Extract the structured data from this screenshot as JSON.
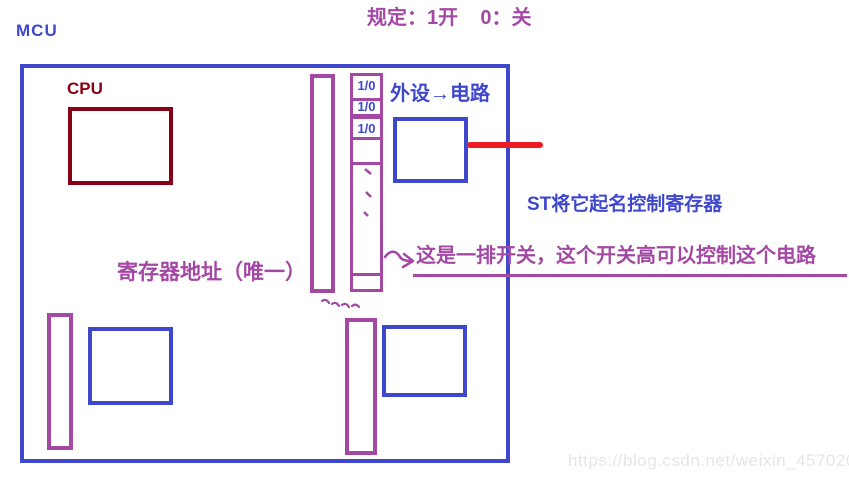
{
  "header": {
    "mcu_title": "MCU",
    "rule_text": "规定：1开    0：关"
  },
  "mcu": {
    "cpu_label": "CPU",
    "register_address_label": "寄存器地址（唯一）",
    "peripheral_label": "外设→电路",
    "switch_cells": [
      "1/0",
      "1/0",
      "1/0"
    ]
  },
  "annotations": {
    "st_register_note": "ST将它起名控制寄存器",
    "switch_row_note": "这是一排开关，这个开关高可以控制这个电路"
  },
  "icons": {
    "arrow": "curved-arrow-icon",
    "squiggle": "squiggle-marks-icon",
    "column_dashes": "ellipsis-dashes-icon"
  },
  "colors": {
    "blue": "#3F48CC",
    "purple": "#A349A4",
    "dark_red": "#880015",
    "red": "#ED1C24",
    "watermark_gray": "#E6E6E6"
  },
  "watermark": "https://blog.csdn.net/weixin_45702091"
}
